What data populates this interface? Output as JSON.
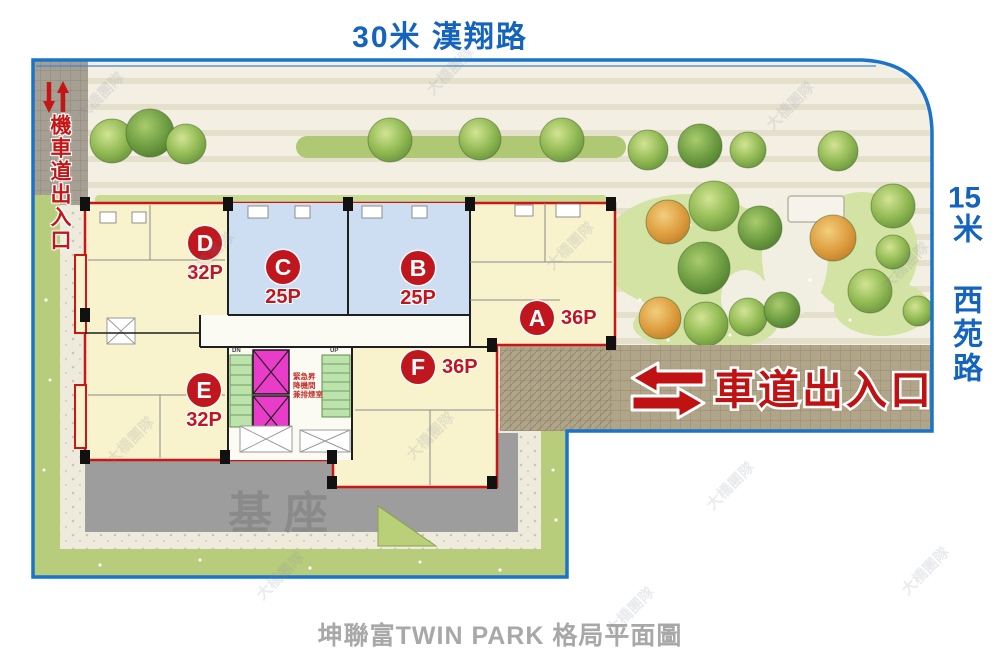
{
  "roads": {
    "top": "30米 漢翔路",
    "right_number": "15",
    "right_rest": "米 西苑路"
  },
  "entrances": {
    "moto": "機車道出入口",
    "drive": "車道出入口"
  },
  "units": [
    {
      "letter": "A",
      "size": "36P",
      "fill": "#f8f2cd"
    },
    {
      "letter": "B",
      "size": "25P",
      "fill": "#cddef2"
    },
    {
      "letter": "C",
      "size": "25P",
      "fill": "#cddef2"
    },
    {
      "letter": "D",
      "size": "32P",
      "fill": "#f8f2cd"
    },
    {
      "letter": "E",
      "size": "32P",
      "fill": "#f8f2cd"
    },
    {
      "letter": "F",
      "size": "36P",
      "fill": "#f8f2cd"
    }
  ],
  "core": {
    "label_lines": [
      "緊急昇",
      "降機間",
      "兼排煙室"
    ],
    "stair_dn": "DN",
    "stair_up": "UP"
  },
  "podium": {
    "label": "基座"
  },
  "caption": "坤聯富TWIN PARK 格局平面圖",
  "watermark": {
    "text": "大橋團隊"
  },
  "colors": {
    "road_text": "#1464bf",
    "entrance_text": "#c01515",
    "unit_badge": "#c0161d",
    "site_boundary": "#1a74c9",
    "building_outline": "#cc1616",
    "unit_yellow": "#f8f2cd",
    "unit_blue": "#cddef2",
    "elevator": "#e93cc9",
    "stair": "#bde3ac",
    "podium_gray": "#9d9d9d",
    "driveway_tan": "#b0a489"
  }
}
